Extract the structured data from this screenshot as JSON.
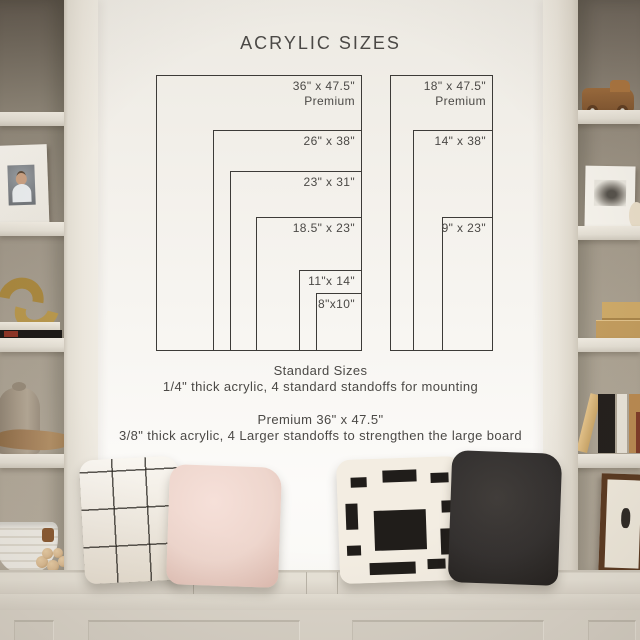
{
  "title": "ACRYLIC SIZES",
  "diagram": {
    "columns": [
      {
        "name": "standard-sizes-column",
        "sizes": [
          {
            "label": "36\" x 47.5\"",
            "sublabel": "Premium",
            "width_in": 36,
            "height_in": 47.5
          },
          {
            "label": "26\" x 38\"",
            "width_in": 26,
            "height_in": 38
          },
          {
            "label": "23\" x 31\"",
            "width_in": 23,
            "height_in": 31
          },
          {
            "label": "18.5\" x 23\"",
            "width_in": 18.5,
            "height_in": 23
          },
          {
            "label": "11\"x 14\"",
            "width_in": 11,
            "height_in": 14
          },
          {
            "label": "8\"x10\"",
            "width_in": 8,
            "height_in": 10
          }
        ]
      },
      {
        "name": "narrow-sizes-column",
        "sizes": [
          {
            "label": "18\" x 47.5\"",
            "sublabel": "Premium",
            "width_in": 18,
            "height_in": 47.5
          },
          {
            "label": "14\" x 38\"",
            "width_in": 14,
            "height_in": 38
          },
          {
            "label": "9\" x 23\"",
            "width_in": 9,
            "height_in": 23
          }
        ]
      }
    ]
  },
  "notes": {
    "standard_title": "Standard Sizes",
    "standard_desc": "1/4\" thick acrylic, 4 standard standoffs for mounting",
    "premium_title": "Premium 36\" x 47.5\"",
    "premium_desc": "3/8\" thick acrylic, 4 Larger standoffs to strengthen the large board"
  },
  "colors": {
    "line": "#3d3b38",
    "text": "#4b4946",
    "wall": "#f3f0ea",
    "shelf_frame": "#e9e4da",
    "shelf_interior": "#a49b8c",
    "bench": "#d9d3c8",
    "pillow_cream": "#f3ede2",
    "pillow_blush": "#eed6cd",
    "pillow_dark": "#343130",
    "pillow_block": "#201d1a",
    "brass": "#a8873f",
    "wood": "#8a5c33"
  }
}
